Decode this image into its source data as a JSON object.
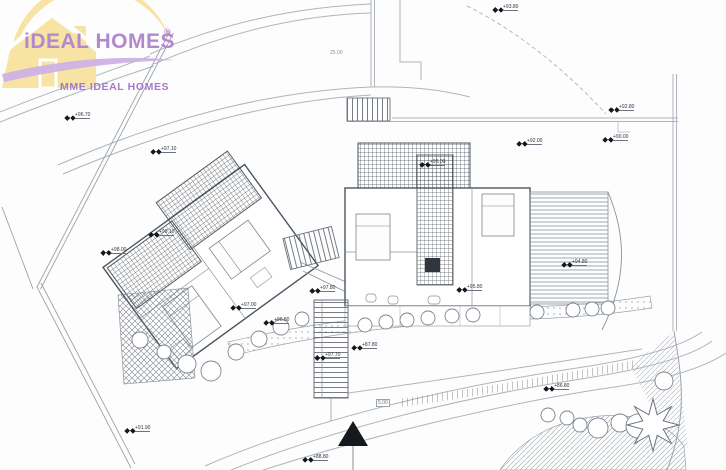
{
  "logo": {
    "brand": "iDEAL HOMES",
    "registered_mark": "®",
    "subtitle": "MME IDEAL HOMES"
  },
  "colors": {
    "brand_purple": "#b289cc",
    "subtitle_purple": "#a678c6",
    "swoosh_purple": "#cdb2e6",
    "logo_yellow": "#f7e3a3",
    "line_gray": "#9aa3ab",
    "wall_gray": "#4a5560",
    "marker_black": "#1b1f24"
  },
  "icons": {
    "survey_point": "solid black bowtie",
    "north_arrow": "▲",
    "tree": "circle outline",
    "palm_tree": "8-point star"
  },
  "plan": {
    "elevation_markers": [
      {
        "label": "+93.80"
      },
      {
        "label": "+96.70"
      },
      {
        "label": "+97.10"
      },
      {
        "label": "+92.80"
      },
      {
        "label": "+90.00"
      },
      {
        "label": "+92.00"
      },
      {
        "label": "+98.00"
      },
      {
        "label": "+99.10"
      },
      {
        "label": "+97.80"
      },
      {
        "label": "+97.00"
      },
      {
        "label": "+96.80"
      },
      {
        "label": "+95.80"
      },
      {
        "label": "+94.80"
      },
      {
        "label": "+96.00"
      },
      {
        "label": "+87.80"
      },
      {
        "label": "+88.80"
      },
      {
        "label": "+86.80"
      },
      {
        "label": "+91.90"
      },
      {
        "label": "+97.70"
      }
    ],
    "dimension_labels": [
      {
        "text": "25.00"
      },
      {
        "text": "5.00"
      }
    ]
  }
}
